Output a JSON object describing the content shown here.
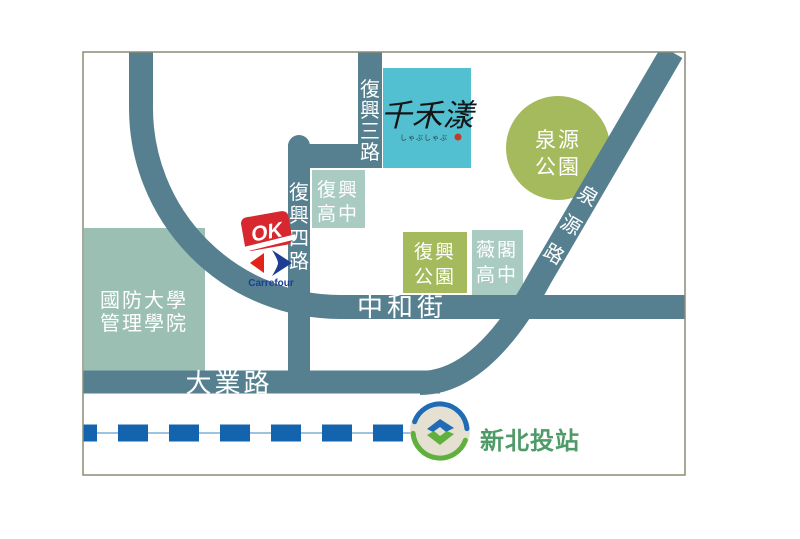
{
  "colors": {
    "road": "#56808F",
    "border": "#8B8B76",
    "park_green": "#A5B95D",
    "campus_green": "#9CBFB4",
    "school_green": "#A9CBC2",
    "brand_teal": "#53C0D2",
    "brand_seal_red": "#C53B22",
    "mrt_blue": "#1463AE",
    "mrt_thin": "#9DC3DF",
    "station_green": "#4F9B68",
    "metro_bg": "#E5E0D1",
    "metro_blue": "#1F6CB4",
    "metro_green": "#5FB03C",
    "ok_red": "#D7282F",
    "carrefour_red": "#E2231A",
    "carrefour_blue": "#1B3E94"
  },
  "roads": {
    "fuxing3": "復興三路",
    "fuxing4": "復興四路",
    "quanyuan": "泉源路",
    "zhonghe": "中和街",
    "daye": "大業路"
  },
  "places": {
    "ndu": {
      "l1": "國防大學",
      "l2": "管理學院"
    },
    "fuxing_hs": {
      "l1": "復興",
      "l2": "高中"
    },
    "weige_hs": {
      "l1": "薇閣",
      "l2": "高中"
    },
    "fuxing_park": {
      "l1": "復興",
      "l2": "公園"
    },
    "quanyuan_park": {
      "l1": "泉源",
      "l2": "公園"
    }
  },
  "brand": {
    "name": "千禾漾",
    "tagline": "しゃぶしゃぶ"
  },
  "stores": {
    "ok": "OK",
    "carrefour": "Carrefour"
  },
  "mrt": {
    "station": "新北投站"
  }
}
